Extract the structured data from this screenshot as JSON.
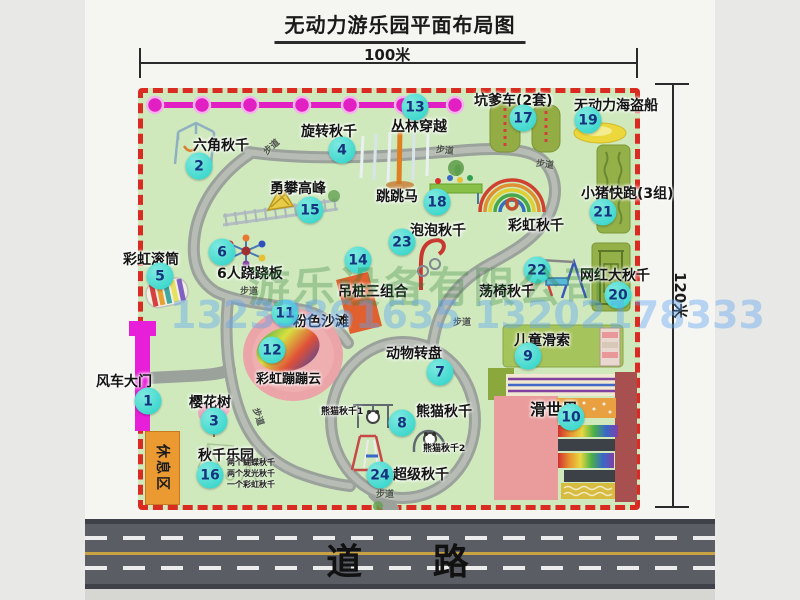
{
  "title": "无动力游乐园平面布局图",
  "dimensions": {
    "width_label": "100米",
    "height_label": "120米"
  },
  "road": {
    "label": "道 路"
  },
  "watermark": {
    "company": "游乐设备有限公司",
    "phone": "13233861635 13202178333"
  },
  "rest_area": {
    "label": "休息区"
  },
  "colors": {
    "map_green": "#cfe9bd",
    "border_red": "#d92b21",
    "marker_teal": "#28d2c7",
    "gate_magenta": "#e81fd8",
    "rest_orange": "#eb9a31",
    "road_gray": "#5b5d64"
  },
  "map": {
    "attractions": [
      {
        "num": 1,
        "name": "风车大门",
        "marker": {
          "x": 148,
          "y": 401
        },
        "label": {
          "x": 96,
          "y": 371
        }
      },
      {
        "num": 2,
        "name": "六角秋千",
        "marker": {
          "x": 199,
          "y": 166
        },
        "label": {
          "x": 193,
          "y": 135
        }
      },
      {
        "num": 3,
        "name": "樱花树",
        "marker": {
          "x": 214,
          "y": 421
        },
        "label": {
          "x": 189,
          "y": 392
        }
      },
      {
        "num": 4,
        "name": "旋转秋千",
        "marker": {
          "x": 342,
          "y": 150
        },
        "label": {
          "x": 301,
          "y": 121
        }
      },
      {
        "num": 5,
        "name": "彩虹滚筒",
        "marker": {
          "x": 160,
          "y": 276
        },
        "label": {
          "x": 123,
          "y": 249
        }
      },
      {
        "num": 6,
        "name": "6人跷跷板",
        "marker": {
          "x": 222,
          "y": 252
        },
        "label": {
          "x": 217,
          "y": 263
        }
      },
      {
        "num": 7,
        "name": "动物转盘",
        "marker": {
          "x": 440,
          "y": 372
        },
        "label": {
          "x": 386,
          "y": 343
        }
      },
      {
        "num": 8,
        "name": "熊猫秋千",
        "marker": {
          "x": 402,
          "y": 423
        },
        "label": {
          "x": 416,
          "y": 401
        }
      },
      {
        "num": 9,
        "name": "儿童滑索",
        "marker": {
          "x": 528,
          "y": 356
        },
        "label": {
          "x": 514,
          "y": 330
        }
      },
      {
        "num": 10,
        "name": "滑世界",
        "marker": {
          "x": 571,
          "y": 417
        },
        "label": {
          "x": 530,
          "y": 396
        },
        "size": 16
      },
      {
        "num": 11,
        "name": "粉色沙滩",
        "marker": {
          "x": 285,
          "y": 313
        },
        "label": {
          "x": 293,
          "y": 311
        }
      },
      {
        "num": 12,
        "name": "彩虹蹦蹦云",
        "marker": {
          "x": 272,
          "y": 350
        },
        "label": {
          "x": 256,
          "y": 368
        },
        "size": 13
      },
      {
        "num": 13,
        "name": "丛林穿越",
        "marker": {
          "x": 415,
          "y": 107
        },
        "label": {
          "x": 391,
          "y": 116
        }
      },
      {
        "num": 14,
        "name": "吊桩三组合",
        "marker": {
          "x": 358,
          "y": 260
        },
        "label": {
          "x": 338,
          "y": 281
        }
      },
      {
        "num": 15,
        "name": "勇攀高峰",
        "marker": {
          "x": 310,
          "y": 210
        },
        "label": {
          "x": 270,
          "y": 178
        }
      },
      {
        "num": 16,
        "name": "秋千乐园",
        "marker": {
          "x": 210,
          "y": 475
        },
        "label": {
          "x": 198,
          "y": 445
        }
      },
      {
        "num": 17,
        "name": "坑爹车(2套)",
        "marker": {
          "x": 523,
          "y": 118
        },
        "label": {
          "x": 474,
          "y": 90
        }
      },
      {
        "num": 18,
        "name": "跳跳马",
        "marker": {
          "x": 437,
          "y": 202
        },
        "label": {
          "x": 376,
          "y": 186
        }
      },
      {
        "num": 19,
        "name": "无动力海盗船",
        "marker": {
          "x": 588,
          "y": 120
        },
        "label": {
          "x": 574,
          "y": 95
        }
      },
      {
        "num": 20,
        "name": "网红大秋千",
        "marker": {
          "x": 618,
          "y": 295
        },
        "label": {
          "x": 580,
          "y": 265
        }
      },
      {
        "num": 21,
        "name": "小猪快跑(3组)",
        "marker": {
          "x": 603,
          "y": 212
        },
        "label": {
          "x": 581,
          "y": 183
        }
      },
      {
        "num": 22,
        "name": "荡椅秋千",
        "marker": {
          "x": 537,
          "y": 270
        },
        "label": {
          "x": 479,
          "y": 281
        }
      },
      {
        "num": 23,
        "name": "泡泡秋千",
        "marker": {
          "x": 402,
          "y": 242
        },
        "label": {
          "x": 410,
          "y": 220
        }
      },
      {
        "num": 24,
        "name": "超级秋千",
        "marker": {
          "x": 380,
          "y": 475
        },
        "label": {
          "x": 393,
          "y": 464
        }
      }
    ],
    "sub_labels": [
      {
        "text": "彩虹秋千",
        "x": 508,
        "y": 215,
        "size": 14
      },
      {
        "text": "熊猫秋千1",
        "x": 321,
        "y": 404,
        "size": 9
      },
      {
        "text": "熊猫秋千2",
        "x": 423,
        "y": 441,
        "size": 9
      }
    ],
    "path_labels": [
      {
        "text": "步道",
        "x": 262,
        "y": 140,
        "rot": -42
      },
      {
        "text": "步道",
        "x": 436,
        "y": 143,
        "rot": 6
      },
      {
        "text": "步道",
        "x": 536,
        "y": 157,
        "rot": 8
      },
      {
        "text": "步道",
        "x": 240,
        "y": 284,
        "rot": 0
      },
      {
        "text": "步道",
        "x": 453,
        "y": 315,
        "rot": 0
      },
      {
        "text": "步道",
        "x": 250,
        "y": 410,
        "rot": 72
      },
      {
        "text": "步道",
        "x": 376,
        "y": 487,
        "rot": 0
      }
    ],
    "swing_park_notes": {
      "x": 227,
      "y": 457,
      "lines": [
        "两个蝴蝶秋千",
        "两个发光秋千",
        "一个彩虹秋千"
      ]
    }
  }
}
